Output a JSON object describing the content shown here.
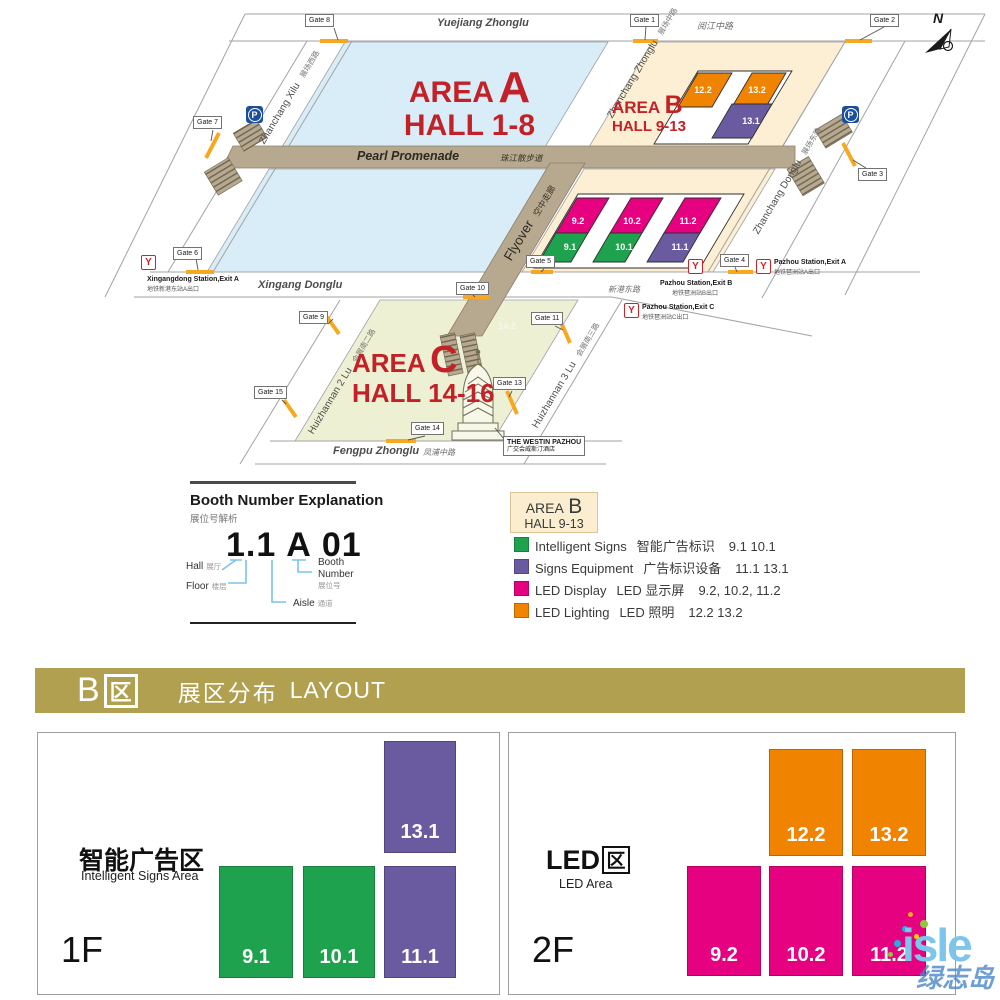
{
  "icons": {
    "metro": "Y",
    "parking": "P",
    "north": "N"
  },
  "colors": {
    "green": "#1fa24d",
    "purple": "#6a5ba1",
    "magenta": "#e5017f",
    "orange": "#f08300",
    "banner_gold": "#b1a050",
    "map_red": "#c32128",
    "area_a_fill": "#d9edf8",
    "area_b_fill": "#fcefd3",
    "area_c_fill": "#eef0d4",
    "promenade_tan": "#b6a98f",
    "gate_dash": "#f7a81f",
    "metro_red": "#c8252c",
    "parking_blue": "#1c4e9e",
    "watermark_blue": "#7dc5ea",
    "callout_blue": "#7cc3e6"
  },
  "map": {
    "areas": {
      "a": {
        "word": "AREA",
        "letter": "A",
        "hall": "HALL 1-8"
      },
      "b": {
        "word": "AREA",
        "letter": "B",
        "hall": "HALL 9-13"
      },
      "c": {
        "word": "AREA",
        "letter": "C",
        "hall": "HALL 14-16"
      }
    },
    "roads": {
      "yuejiang": {
        "en": "Yuejiang Zhonglu",
        "zh": "阅江中路"
      },
      "xingang": {
        "en": "Xingang Donglu",
        "zh": "新港东路"
      },
      "fengpu": {
        "en": "Fengpu Zhonglu",
        "zh": "凤浦中路"
      },
      "promenade": {
        "en": "Pearl Promenade",
        "zh": "珠江散步道"
      },
      "flyover": {
        "en": "Flyover",
        "zh": "空中走廊"
      },
      "zhanchang_xilu": {
        "en": "Zhanchang Xilu",
        "zh": "展场西路"
      },
      "zhanchang_zhonglu": {
        "en": "Zhanchang Zhonglu",
        "zh": "展场中路"
      },
      "zhanchang_donglu": {
        "en": "Zhanchang Donglu",
        "zh": "展场东路"
      },
      "huizhannan2": {
        "en": "Huizhannan 2 Lu",
        "zh": "会展南二路"
      },
      "huizhannan3": {
        "en": "Huizhannan 3 Lu",
        "zh": "会展南三路"
      }
    },
    "gates": [
      "Gate 8",
      "Gate 1",
      "Gate 2",
      "Gate 7",
      "Gate 3",
      "Gate 6",
      "Gate 5",
      "Gate 4",
      "Gate 10",
      "Gate 9",
      "Gate 11",
      "Gate 15",
      "Gate 13",
      "Gate 14"
    ],
    "stations": [
      {
        "en": "Xingangdong Station,Exit A",
        "zh": "地铁新港东站A出口"
      },
      {
        "en": "Pazhou Station,Exit A",
        "zh": "地铁琶洲站A出口"
      },
      {
        "en": "Pazhou Station,Exit B",
        "zh": "地铁琶洲站B出口"
      },
      {
        "en": "Pazhou Station,Exit C",
        "zh": "地铁琶洲站C出口"
      }
    ],
    "halls": {
      "h122": "12.2",
      "h132": "13.2",
      "h131": "13.1",
      "h92": "9.2",
      "h102": "10.2",
      "h112": "11.2",
      "h91": "9.1",
      "h101": "10.1",
      "h111": "11.1",
      "faint": "14.2"
    },
    "hotel": {
      "en": "THE WESTIN PAZHOU",
      "zh": "广交会威斯汀酒店"
    }
  },
  "booth": {
    "title": "Booth Number Explanation",
    "title_zh": "展位号解析",
    "example": {
      "hall_floor": "1.1",
      "aisle": "A",
      "booth": "01"
    },
    "labels": {
      "hall_en": "Hall",
      "hall_zh": "展厅",
      "floor_en": "Floor",
      "floor_zh": "楼层",
      "aisle_en": "Aisle",
      "aisle_zh": "通道",
      "booth_en1": "Booth",
      "booth_en2": "Number",
      "booth_zh": "展位号"
    }
  },
  "legend": {
    "box": {
      "word": "AREA",
      "letter": "B",
      "hall": "HALL 9-13"
    },
    "items": [
      {
        "en": "Intelligent Signs",
        "zh": "智能广告标识",
        "halls": "9.1 10.1",
        "color": "#1fa24d"
      },
      {
        "en": "Signs Equipment",
        "zh": "广告标识设备",
        "halls": "11.1  13.1",
        "color": "#6a5ba1"
      },
      {
        "en": "LED Display",
        "zh": "LED 显示屏",
        "halls": "9.2, 10.2, 11.2",
        "color": "#e5017f"
      },
      {
        "en": "LED Lighting",
        "zh": "LED 照明",
        "halls": "12.2  13.2",
        "color": "#f08300"
      }
    ]
  },
  "banner": {
    "letter": "B",
    "box_char": "区",
    "zh": "展区分布",
    "en": "LAYOUT"
  },
  "panels": {
    "f1": {
      "floor": "1F",
      "title": "智能广告区",
      "subtitle": "Intelligent Signs Area",
      "halls": [
        {
          "id": "13.1"
        },
        {
          "id": "9.1"
        },
        {
          "id": "10.1"
        },
        {
          "id": "11.1"
        }
      ]
    },
    "f2": {
      "floor": "2F",
      "title_prefix": "LED",
      "title_box": "区",
      "subtitle": "LED Area",
      "halls": [
        {
          "id": "12.2"
        },
        {
          "id": "13.2"
        },
        {
          "id": "9.2"
        },
        {
          "id": "10.2"
        },
        {
          "id": "11.2"
        }
      ]
    }
  },
  "watermark": {
    "text": "isle",
    "zh": "绿志岛"
  }
}
